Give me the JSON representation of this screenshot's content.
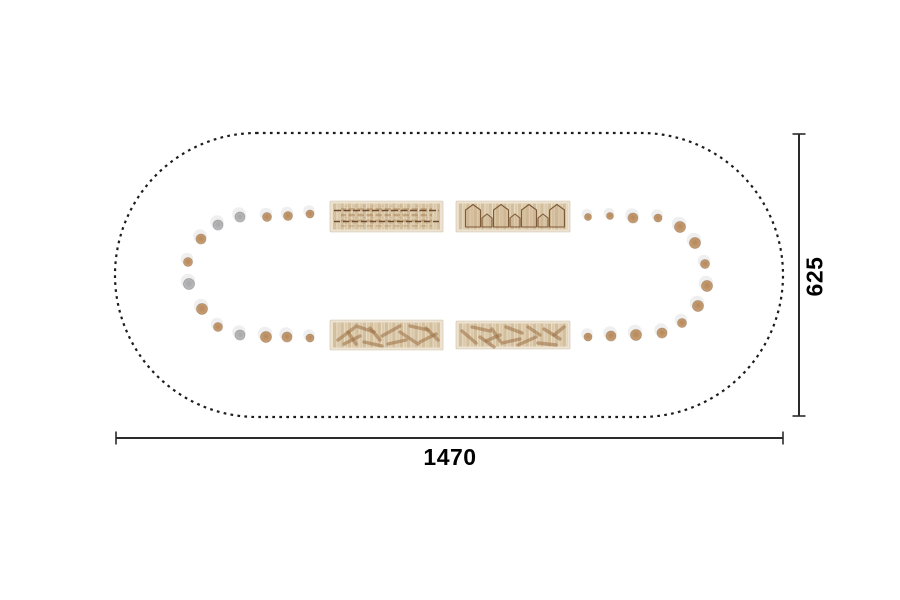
{
  "page": {
    "background": "#ffffff"
  },
  "drawing": {
    "kind": "oval-table-top-view-plan",
    "outline": {
      "x": 115,
      "y": 133,
      "width": 668,
      "height": 284,
      "corner_radius": 142,
      "stroke": "#1c1c1c",
      "style": "dotted"
    },
    "colors": {
      "wood_stool": "#c2976c",
      "gray_stool": "#b4b4b6",
      "stool_halo": "#ececec",
      "table_wood": "#dcc9ab",
      "table_edge": "#ece3d2",
      "outline_dot": "#1c1c1c",
      "dimension_line": "#2b2b2b"
    },
    "tables": [
      {
        "id": "table-top-left",
        "x": 330,
        "y": 201,
        "width": 113,
        "height": 31,
        "deco": "bricks"
      },
      {
        "id": "table-top-right",
        "x": 456,
        "y": 201,
        "width": 114,
        "height": 31,
        "deco": "arches"
      },
      {
        "id": "table-bottom-left",
        "x": 330,
        "y": 320,
        "width": 113,
        "height": 30,
        "deco": "sticks-a"
      },
      {
        "id": "table-bottom-right",
        "x": 456,
        "y": 321,
        "width": 114,
        "height": 28,
        "deco": "sticks-b"
      }
    ],
    "stools": [
      {
        "x": 310,
        "y": 214,
        "r": 4.0,
        "color": "wood"
      },
      {
        "x": 288,
        "y": 216,
        "r": 4.5,
        "color": "wood"
      },
      {
        "x": 267,
        "y": 217,
        "r": 4.5,
        "color": "wood"
      },
      {
        "x": 240,
        "y": 217,
        "r": 5.0,
        "color": "gray"
      },
      {
        "x": 218,
        "y": 225,
        "r": 5.0,
        "color": "gray"
      },
      {
        "x": 201,
        "y": 239,
        "r": 5.0,
        "color": "wood"
      },
      {
        "x": 188,
        "y": 262,
        "r": 4.5,
        "color": "wood"
      },
      {
        "x": 189,
        "y": 284,
        "r": 5.5,
        "color": "gray"
      },
      {
        "x": 202,
        "y": 309,
        "r": 5.5,
        "color": "wood"
      },
      {
        "x": 218,
        "y": 327,
        "r": 4.5,
        "color": "wood"
      },
      {
        "x": 240,
        "y": 335,
        "r": 5.0,
        "color": "gray"
      },
      {
        "x": 266,
        "y": 337,
        "r": 5.5,
        "color": "wood"
      },
      {
        "x": 287,
        "y": 337,
        "r": 5.0,
        "color": "wood"
      },
      {
        "x": 310,
        "y": 338,
        "r": 4.0,
        "color": "wood"
      },
      {
        "x": 588,
        "y": 217,
        "r": 3.5,
        "color": "wood"
      },
      {
        "x": 610,
        "y": 216,
        "r": 3.5,
        "color": "wood"
      },
      {
        "x": 633,
        "y": 218,
        "r": 5.0,
        "color": "wood"
      },
      {
        "x": 658,
        "y": 218,
        "r": 4.0,
        "color": "wood"
      },
      {
        "x": 680,
        "y": 227,
        "r": 5.5,
        "color": "wood"
      },
      {
        "x": 695,
        "y": 243,
        "r": 5.5,
        "color": "wood"
      },
      {
        "x": 705,
        "y": 264,
        "r": 4.5,
        "color": "wood"
      },
      {
        "x": 707,
        "y": 286,
        "r": 5.5,
        "color": "wood"
      },
      {
        "x": 698,
        "y": 306,
        "r": 5.5,
        "color": "wood"
      },
      {
        "x": 682,
        "y": 323,
        "r": 4.5,
        "color": "wood"
      },
      {
        "x": 662,
        "y": 333,
        "r": 5.0,
        "color": "wood"
      },
      {
        "x": 636,
        "y": 335,
        "r": 5.5,
        "color": "wood"
      },
      {
        "x": 611,
        "y": 336,
        "r": 5.0,
        "color": "wood"
      },
      {
        "x": 588,
        "y": 337,
        "r": 4.0,
        "color": "wood"
      }
    ]
  },
  "dimensions": {
    "width": {
      "label": "1470",
      "x1": 116,
      "x2": 783,
      "y": 438,
      "tick": 13
    },
    "height": {
      "label": "625",
      "y1": 134,
      "y2": 416,
      "x": 799,
      "tick": 13
    }
  }
}
